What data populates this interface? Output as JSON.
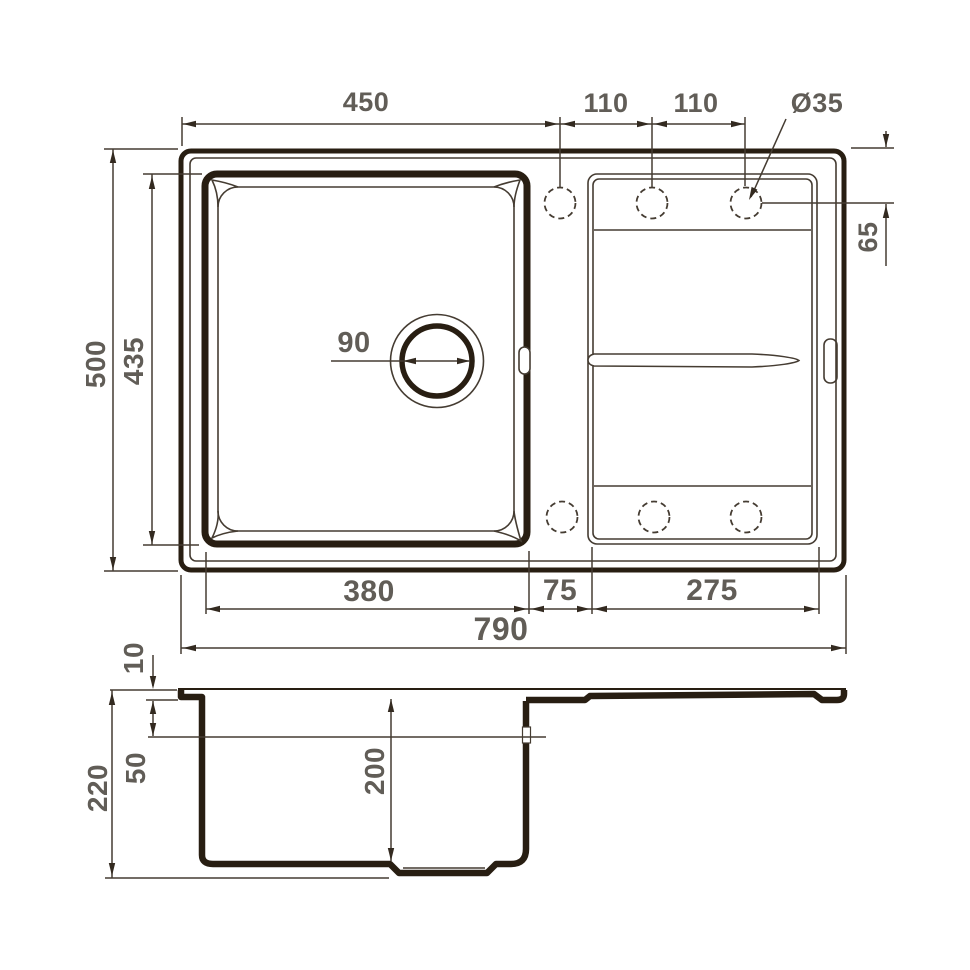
{
  "colors": {
    "outline": "#281e12",
    "thin_line": "#453c32",
    "dim_text": "#615d57",
    "background": "#ffffff"
  },
  "top_view": {
    "dim_450": "450",
    "dim_110_a": "110",
    "dim_110_b": "110",
    "dim_hole": "Ø35",
    "dim_500": "500",
    "dim_435": "435",
    "dim_65": "65",
    "dim_drain": "90",
    "dim_380": "380",
    "dim_75": "75",
    "dim_275": "275",
    "dim_790": "790"
  },
  "section_view": {
    "dim_10": "10",
    "dim_50": "50",
    "dim_220": "220",
    "dim_200": "200"
  }
}
